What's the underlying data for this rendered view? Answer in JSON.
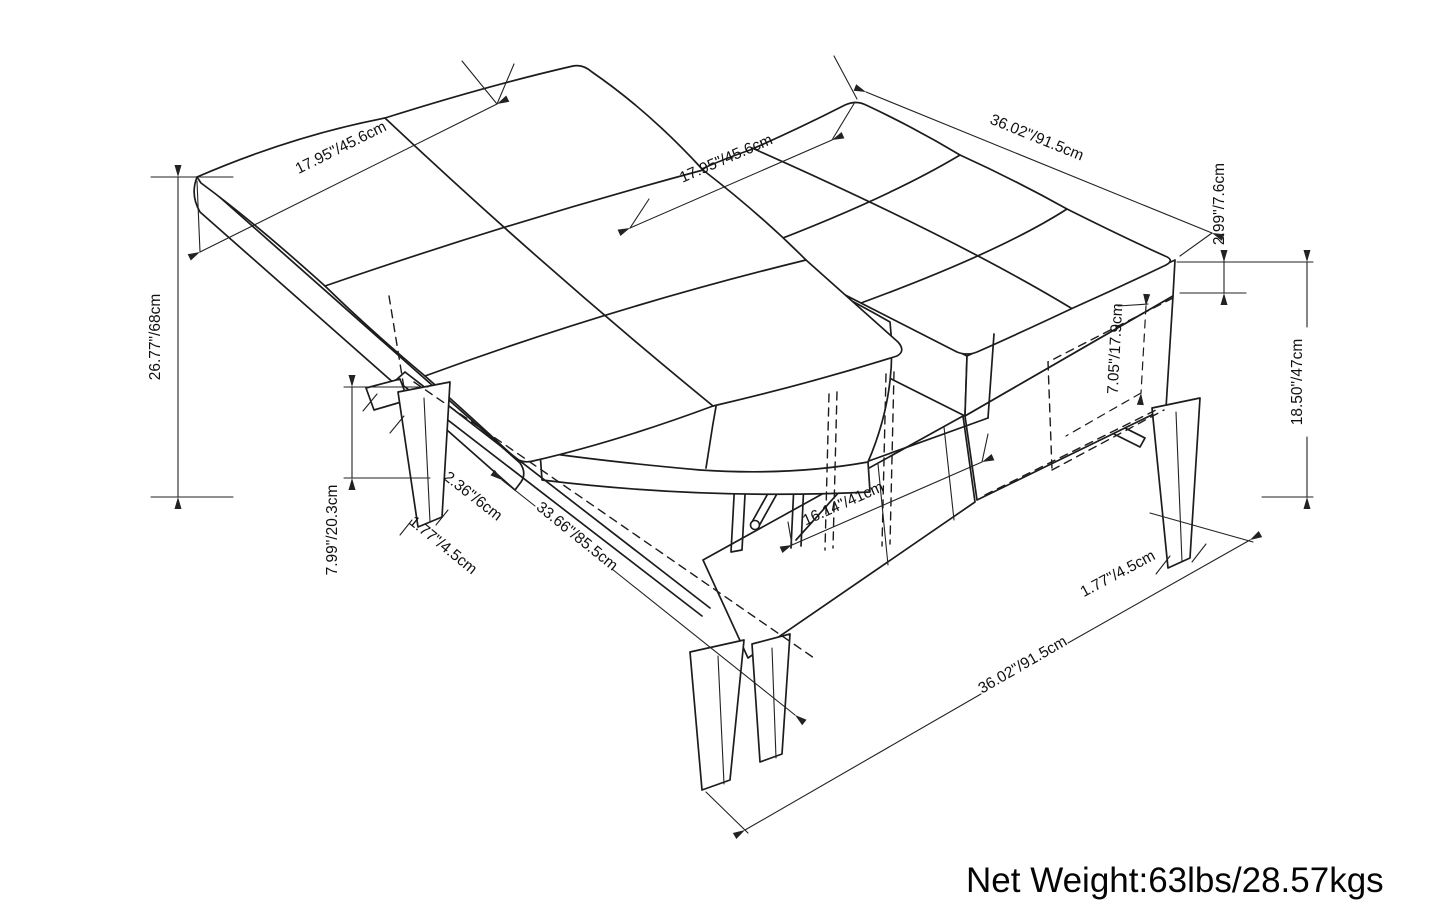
{
  "style": {
    "line_color": "#1c1c1c",
    "background": "#ffffff",
    "text_color": "#111111"
  },
  "dims": {
    "lid_width": "17.95\"/45.6cm",
    "top_width": "17.95\"/45.6cm",
    "top_length": "36.02\"/91.5cm",
    "cushion_thickness": "2.99\"/7.6cm",
    "open_height": "26.77\"/68cm",
    "clearance_height": "7.99\"/20.3cm",
    "rail_width": "2.36\"/6cm",
    "leg_width_left": "1.77\"/4.5cm",
    "lid_length": "33.66\"/85.5cm",
    "opening_width": "16.14\"/41cm",
    "storage_depth": "7.05\"/17.9cm",
    "table_height": "18.50\"/47cm",
    "leg_width_right": "1.77\"/4.5cm",
    "base_length": "36.02\"/91.5cm"
  },
  "footer": {
    "net_weight": "Net Weight:63lbs/28.57kgs"
  }
}
